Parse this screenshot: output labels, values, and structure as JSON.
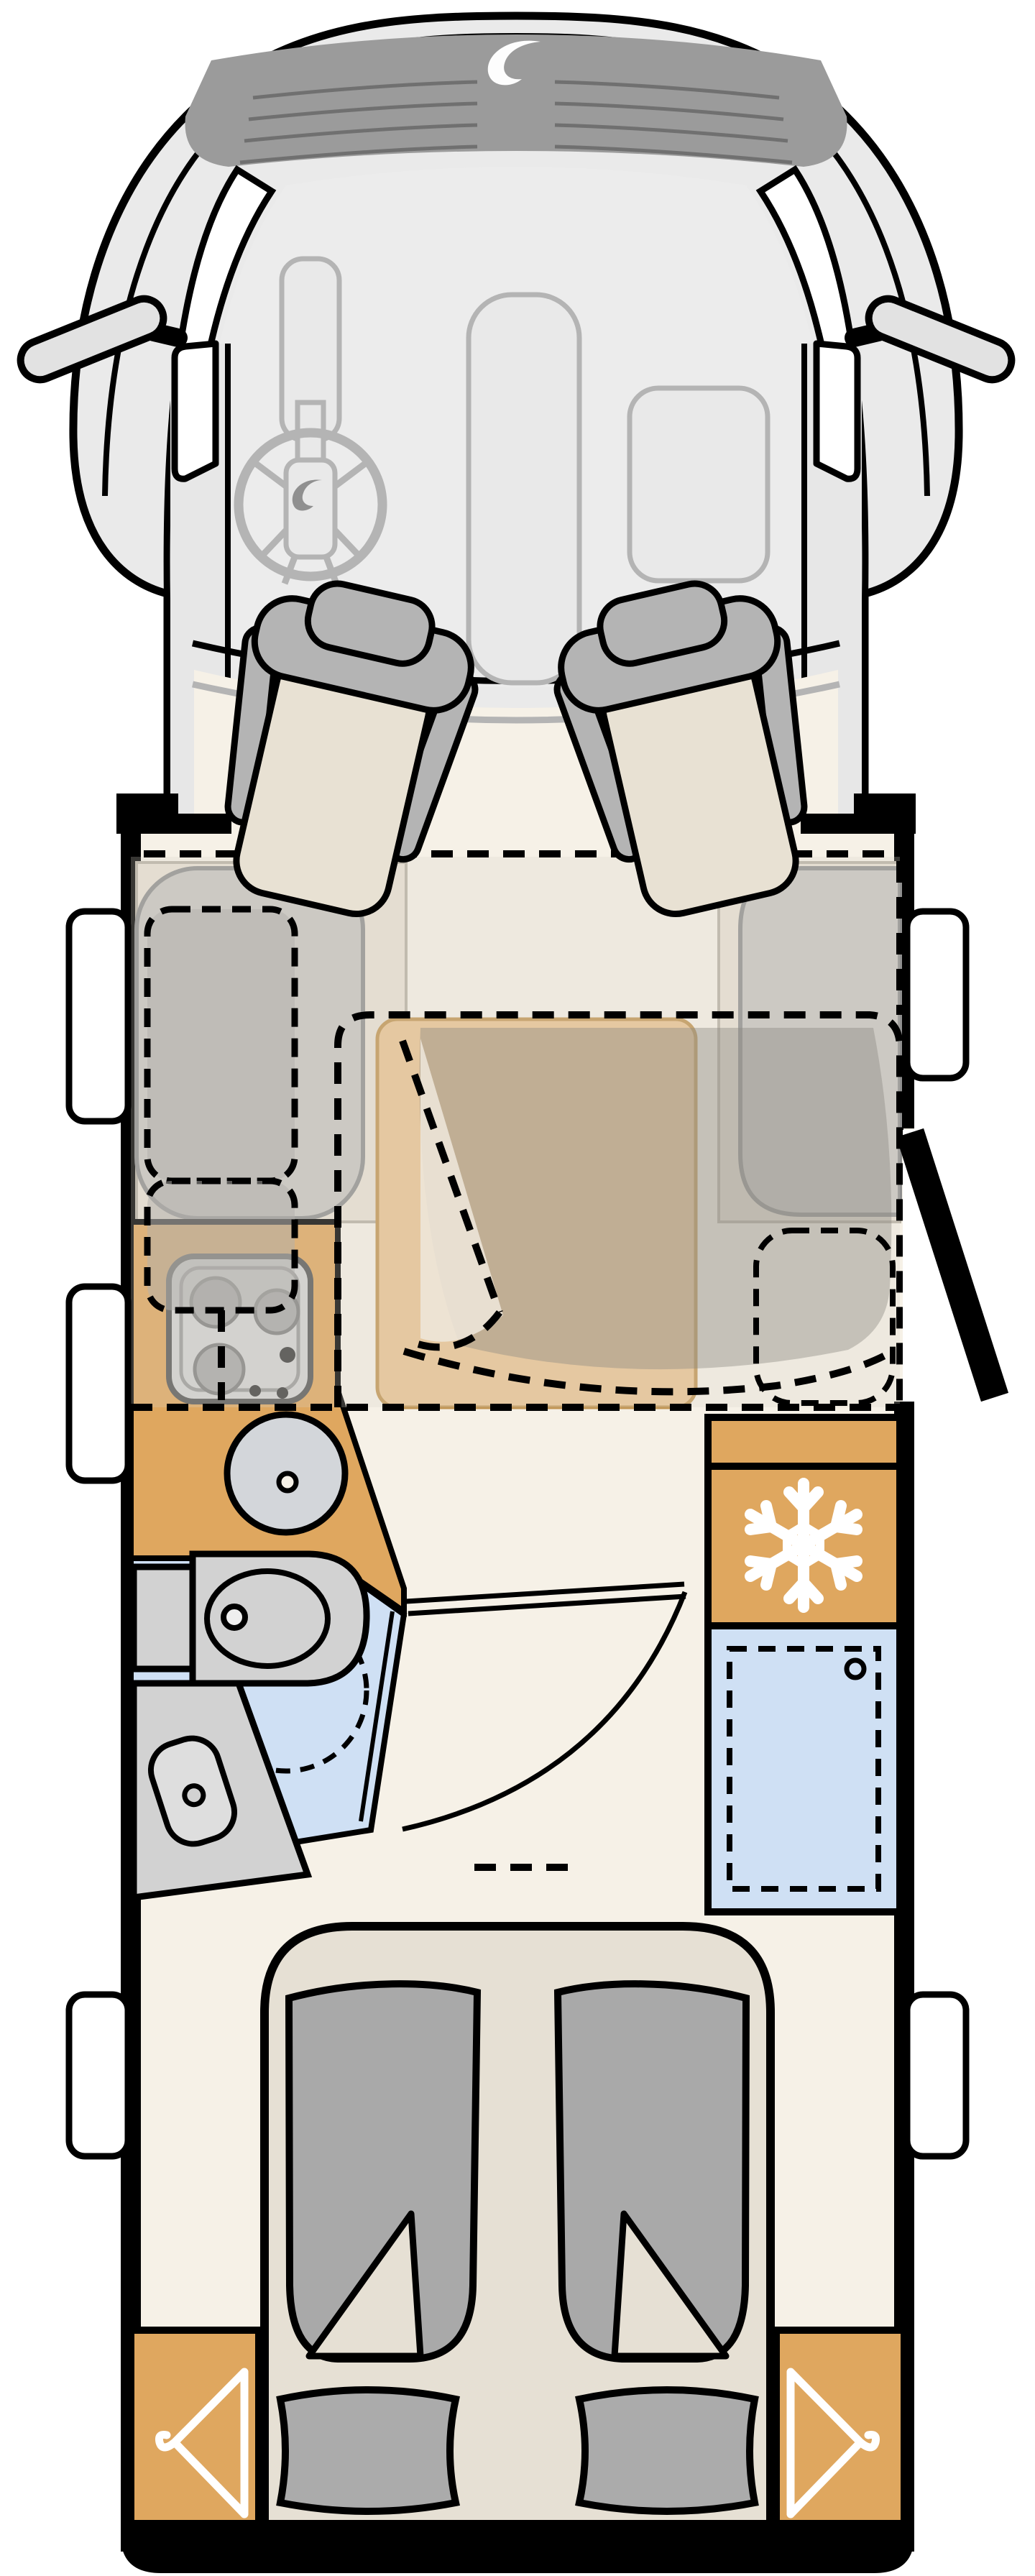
{
  "page": {
    "title": "Motorhome floor plan — top view"
  },
  "colors": {
    "black": "#000000",
    "white": "#ffffff",
    "bodyGray": "#eaeaea",
    "windshield": "#ececec",
    "ventBand": "#9b9b9b",
    "ventGroove": "#707070",
    "dashGray": "#b4b4b4",
    "dashFill": "#e9e9e9",
    "floorCream": "#f6f1e7",
    "seatBeige": "#e8e1d3",
    "seatGray": "#b4b4b4",
    "sofaGray": "#c8c6c1",
    "sofaBeige": "#e8e1d4",
    "sofaStroke": "#8f8f8f",
    "tableTan": "#eac494",
    "tableStroke": "#c19553",
    "counterOrange": "#dfa75f",
    "bathBlue": "#cfe0f4",
    "fixtureGray": "#d2d2d2",
    "fixtureLight": "#dedede",
    "mattressGray": "#a9a9a9",
    "platformBeige": "#e6e0d4",
    "overlayGray": "#d8d3c8",
    "blanketGray": "#8d8a84",
    "bedShadow": "#b2b0ab",
    "logoWhite": "#fdfdfd",
    "steerLogoGray": "#909090"
  },
  "floorplan": {
    "vehicle": "motorhome",
    "view": "top-down",
    "front": "top",
    "areas": [
      {
        "name": "cab",
        "features": [
          "windshield",
          "vent-band-with-logo",
          "dashboard",
          "steering-wheel",
          "center-console",
          "glovebox",
          "left-mirror",
          "right-mirror",
          "driver-seat",
          "passenger-seat",
          "cab-door-windows"
        ]
      },
      {
        "name": "lounge",
        "features": [
          "left-sofa",
          "right-sofa",
          "table",
          "drop-down-bed-dashed-outline",
          "folded-blanket"
        ]
      },
      {
        "name": "kitchen",
        "features": [
          "counter",
          "cooktop-3-burners",
          "round-sink",
          "kitchen-window"
        ]
      },
      {
        "name": "bathroom",
        "features": [
          "toilet",
          "vanity",
          "washbasin",
          "shower-dashed-outline",
          "bathroom-door-open"
        ]
      },
      {
        "name": "storage",
        "features": [
          "refrigerator-with-snowflake",
          "wardrobe-with-dashed-door"
        ]
      },
      {
        "name": "rear-bedroom",
        "features": [
          "twin-bed-left",
          "twin-bed-right",
          "folded-blanket-corners",
          "pillow-left",
          "pillow-right",
          "wardrobe-left-hanger",
          "wardrobe-right-hanger"
        ]
      }
    ],
    "doors": [
      {
        "name": "entry-door",
        "state": "open",
        "side": "right"
      },
      {
        "name": "bathroom-door",
        "state": "open"
      }
    ],
    "windows": [
      "left-lounge-window",
      "left-kitchen-window",
      "left-rear-window",
      "right-lounge-window",
      "right-rear-window",
      "left-cab-door-window",
      "right-cab-door-window"
    ],
    "icons": [
      {
        "name": "snowflake-icon",
        "meaning": "refrigerator"
      },
      {
        "name": "hanger-icon",
        "meaning": "wardrobe"
      },
      {
        "name": "brand-swoosh-icon",
        "meaning": "manufacturer logo on cowl"
      },
      {
        "name": "steering-logo-icon",
        "meaning": "chassis logo on steering wheel"
      }
    ]
  }
}
